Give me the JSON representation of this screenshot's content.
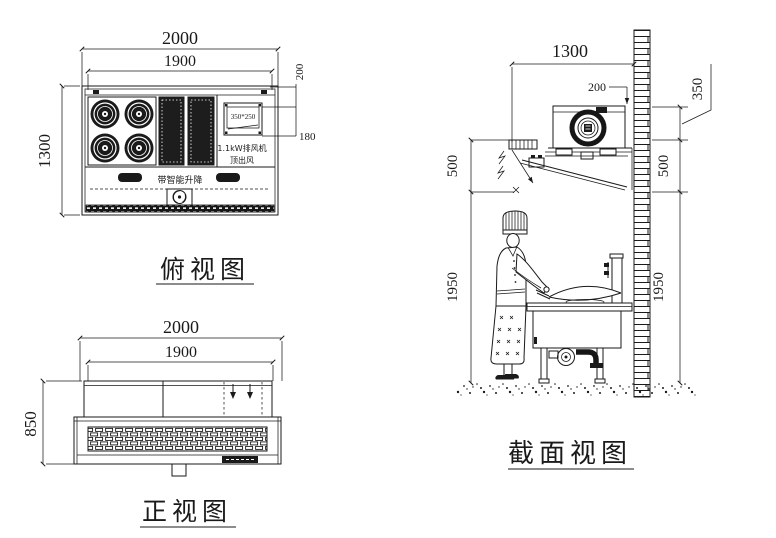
{
  "palette": {
    "ink": "#1a1a1a",
    "paper": "#ffffff"
  },
  "drawing": {
    "top_view": {
      "label": "俯视图",
      "dims": {
        "overall_width": "2000",
        "inner_width": "1900",
        "depth": "1300",
        "edge_offset": "200",
        "outlet_offset": "180"
      },
      "outlet_size_label": "350*250",
      "fan_power_label": "1.1kW排风机",
      "air_outlet_label": "顶出风",
      "smart_lift_label": "带智能升降"
    },
    "front_view": {
      "label": "正视图",
      "dims": {
        "overall_width": "2000",
        "inner_width": "1900",
        "height": "850"
      }
    },
    "section_view": {
      "label": "截面视图",
      "dims": {
        "hood_width": "1300",
        "duct_offset": "200",
        "top_clearance": "350",
        "hood_height_left": "500",
        "hood_height_right": "500",
        "working_height_left": "1950",
        "working_height_right": "1950"
      }
    }
  }
}
